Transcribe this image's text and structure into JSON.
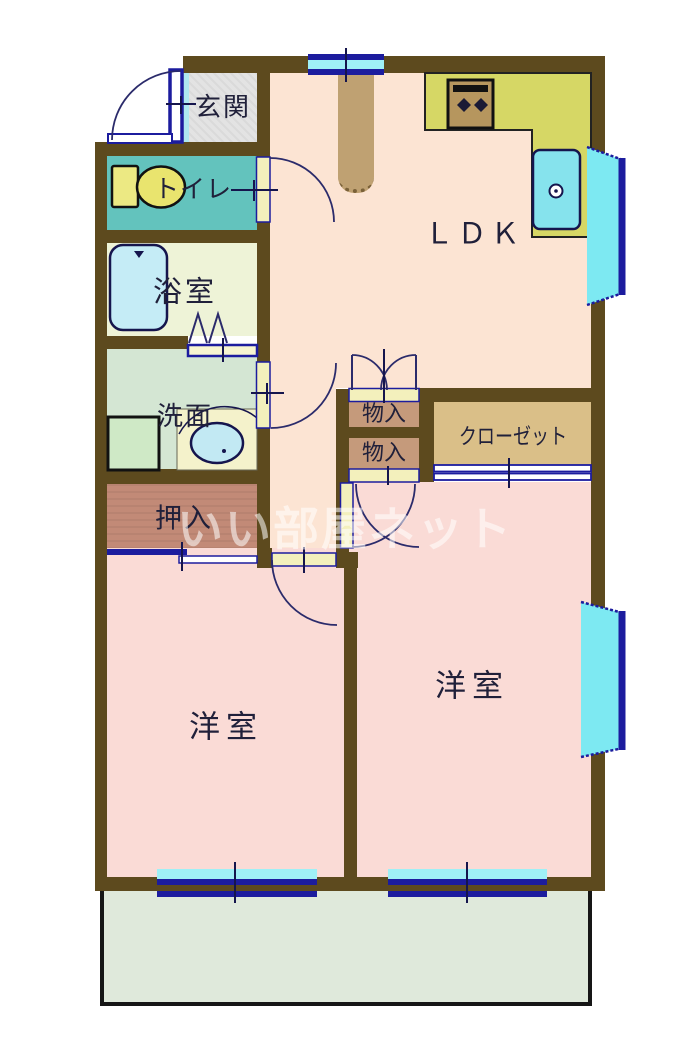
{
  "rooms": {
    "genkan": "玄関",
    "toilet": "トイレ",
    "bath": "浴室",
    "washroom": "洗面",
    "oshiire": "押入",
    "ldk": "ＬＤＫ",
    "storage1": "物入",
    "storage2": "物入",
    "closet": "クローゼット",
    "bedroom_left": "洋室",
    "bedroom_right": "洋室"
  },
  "watermark": "いい部屋ネット",
  "icons": {
    "bathtub": "bathtub-icon",
    "toilet_fixture": "toilet-icon",
    "kitchen_sink": "kitchen-sink-icon",
    "stove": "stove-icon",
    "washing_machine_pan": "washing-machine-pan-icon",
    "vanity_basin": "vanity-basin-icon",
    "door_swing": "door-swing-arc",
    "folding_door": "folding-door-zigzag"
  },
  "colors": {
    "wall": "#5d4a1e",
    "ldk_floor": "#fce4d3",
    "bedroom_floor": "#fadbd6",
    "toilet_floor": "#63c3bd",
    "bath_floor": "#eef3d7",
    "washroom_floor": "#d4e6d3",
    "oshiire_floor": "#c28a77",
    "storage_floor": "#c59a7b",
    "closet_floor": "#dabf88",
    "genkan_floor": "#e3e3e3",
    "balcony_floor": "#dfe9db",
    "kitchen_counter": "#d6d765",
    "window_frame": "#1c1c9e",
    "window_glass": "#7de9f2",
    "door_panel": "#f3f0bc"
  }
}
